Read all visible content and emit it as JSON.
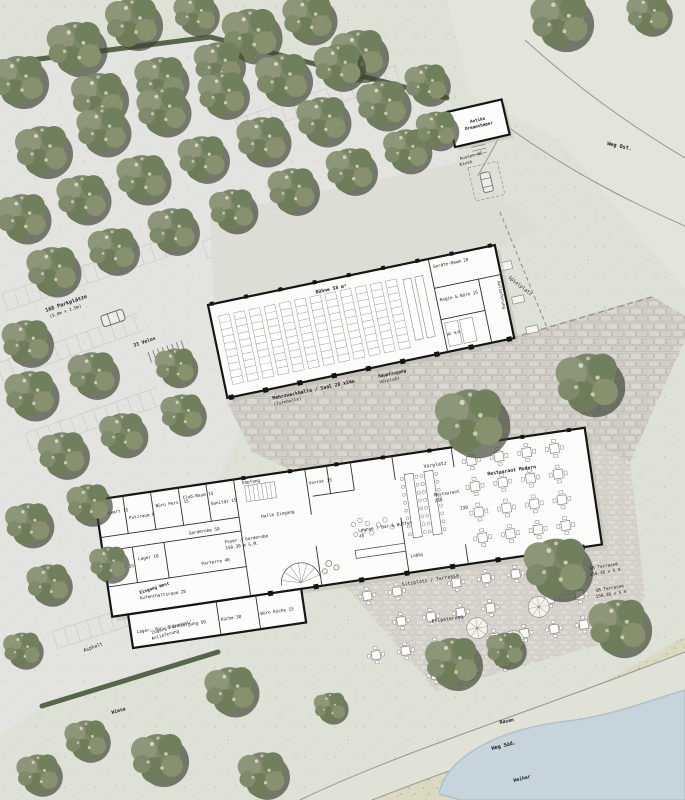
{
  "site": {
    "path_east": "Weg Ost.",
    "path_south": "Weg Süd.",
    "lawn": "Rasen",
    "pond": "Weiher",
    "meadow": "Wiese",
    "asphalt": "Asphalt",
    "paving": "Pflästerung",
    "forecourt": "Vorplatz",
    "playground": "Spielplatz",
    "terrace_seating": "Sitzplatz / Terrasse",
    "terrace_dim_a1": "GR Terrasse",
    "terrace_dim_a2": "150.16 x 5 m",
    "terrace_dim_b1": "GR Terrasse",
    "terrace_dim_b2": "150.30 x 5 m",
    "entrance_west": "Eingang West",
    "entrance_staff1": "Zugang Personal/",
    "entrance_staff2": "Anlieferung",
    "kiosk1": "Antike",
    "kiosk2": "Dreamshaper",
    "kiosk_wc1": "Aussen-WC",
    "kiosk_wc2": "Kiosk"
  },
  "parking": {
    "count": "168 Parkplätze",
    "stall_size": "(5.0m x 2.5m)",
    "bikes": "33 Velos"
  },
  "hall": {
    "stage": "Bühne 58 m²",
    "name1": "Mehrzweckhalle / Saal 28 x24m",
    "name2": "(Turnhalle)",
    "main_entrance1": "Hauptzugang",
    "main_entrance2": "Vorplatz",
    "storage": "Geräte-Raum 28",
    "control": "Regie & Büro 15",
    "wc": "WC H/D",
    "delivery": "Anlieferung"
  },
  "building": {
    "hauswart": "Hauswart 15",
    "putzraum": "Putzraum 8",
    "buero_personal": "Büro Pers. 15",
    "clubraum": "Club-Raum 15",
    "sanitaet": "Sanität 15",
    "garderobe": "Garderobe 50",
    "empfang": "Empfang",
    "halle_eingang": "Halle Eingang",
    "foyer1": "Foyer / Garderobe",
    "foyer2": "150.30 m G.M.",
    "parterre": "Parterre 40",
    "technik": "Technik 15",
    "lager": "Lager 18",
    "aufenthalt": "Aufenthaltsraum 28",
    "lager_entsorgung": "Lager, Vor- & Entsorgung 50",
    "kueche": "Küche 38",
    "buero_kueche": "Büro Küche 15",
    "vorrat": "Vorrat 15"
  },
  "restaurant": {
    "name": "Restaurant Modern",
    "label": "Restaurant",
    "seats": "230",
    "lounge1": "Lounge / Bar & Buffet",
    "lounge2": "45",
    "lobby": "Lobby",
    "count": "230"
  }
}
